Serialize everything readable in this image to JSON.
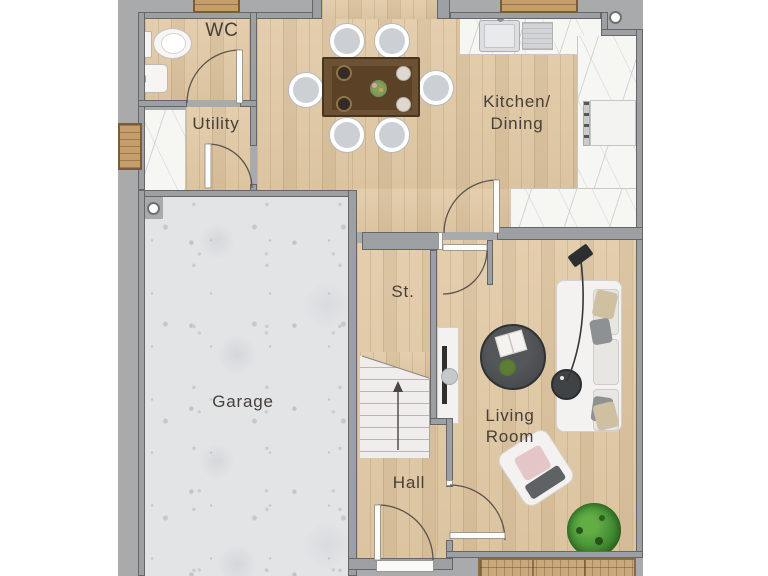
{
  "floorplan": {
    "rooms": [
      {
        "id": "wc",
        "label": "WC"
      },
      {
        "id": "utility",
        "label": "Utility"
      },
      {
        "id": "kitchen-dining",
        "label_line1": "Kitchen/",
        "label_line2": "Dining"
      },
      {
        "id": "garage",
        "label": "Garage"
      },
      {
        "id": "storage",
        "label": "St."
      },
      {
        "id": "hall",
        "label": "Hall"
      },
      {
        "id": "living-room",
        "label_line1": "Living",
        "label_line2": "Room"
      }
    ],
    "stairs": {
      "direction_arrow": "up"
    },
    "colors": {
      "site_background": "#a8aaac",
      "wall_fill": "#9da0a3",
      "wall_outline": "#63666a",
      "wood_floor": "#e2cba8",
      "marble_floor": "#f6f6f3",
      "concrete_floor": "#e3e4e6",
      "deck_wood": "#c9a97c",
      "label_text": "#46403a",
      "plant_green": "#4e9b3c",
      "sofa_white": "#f3f2f0"
    }
  }
}
